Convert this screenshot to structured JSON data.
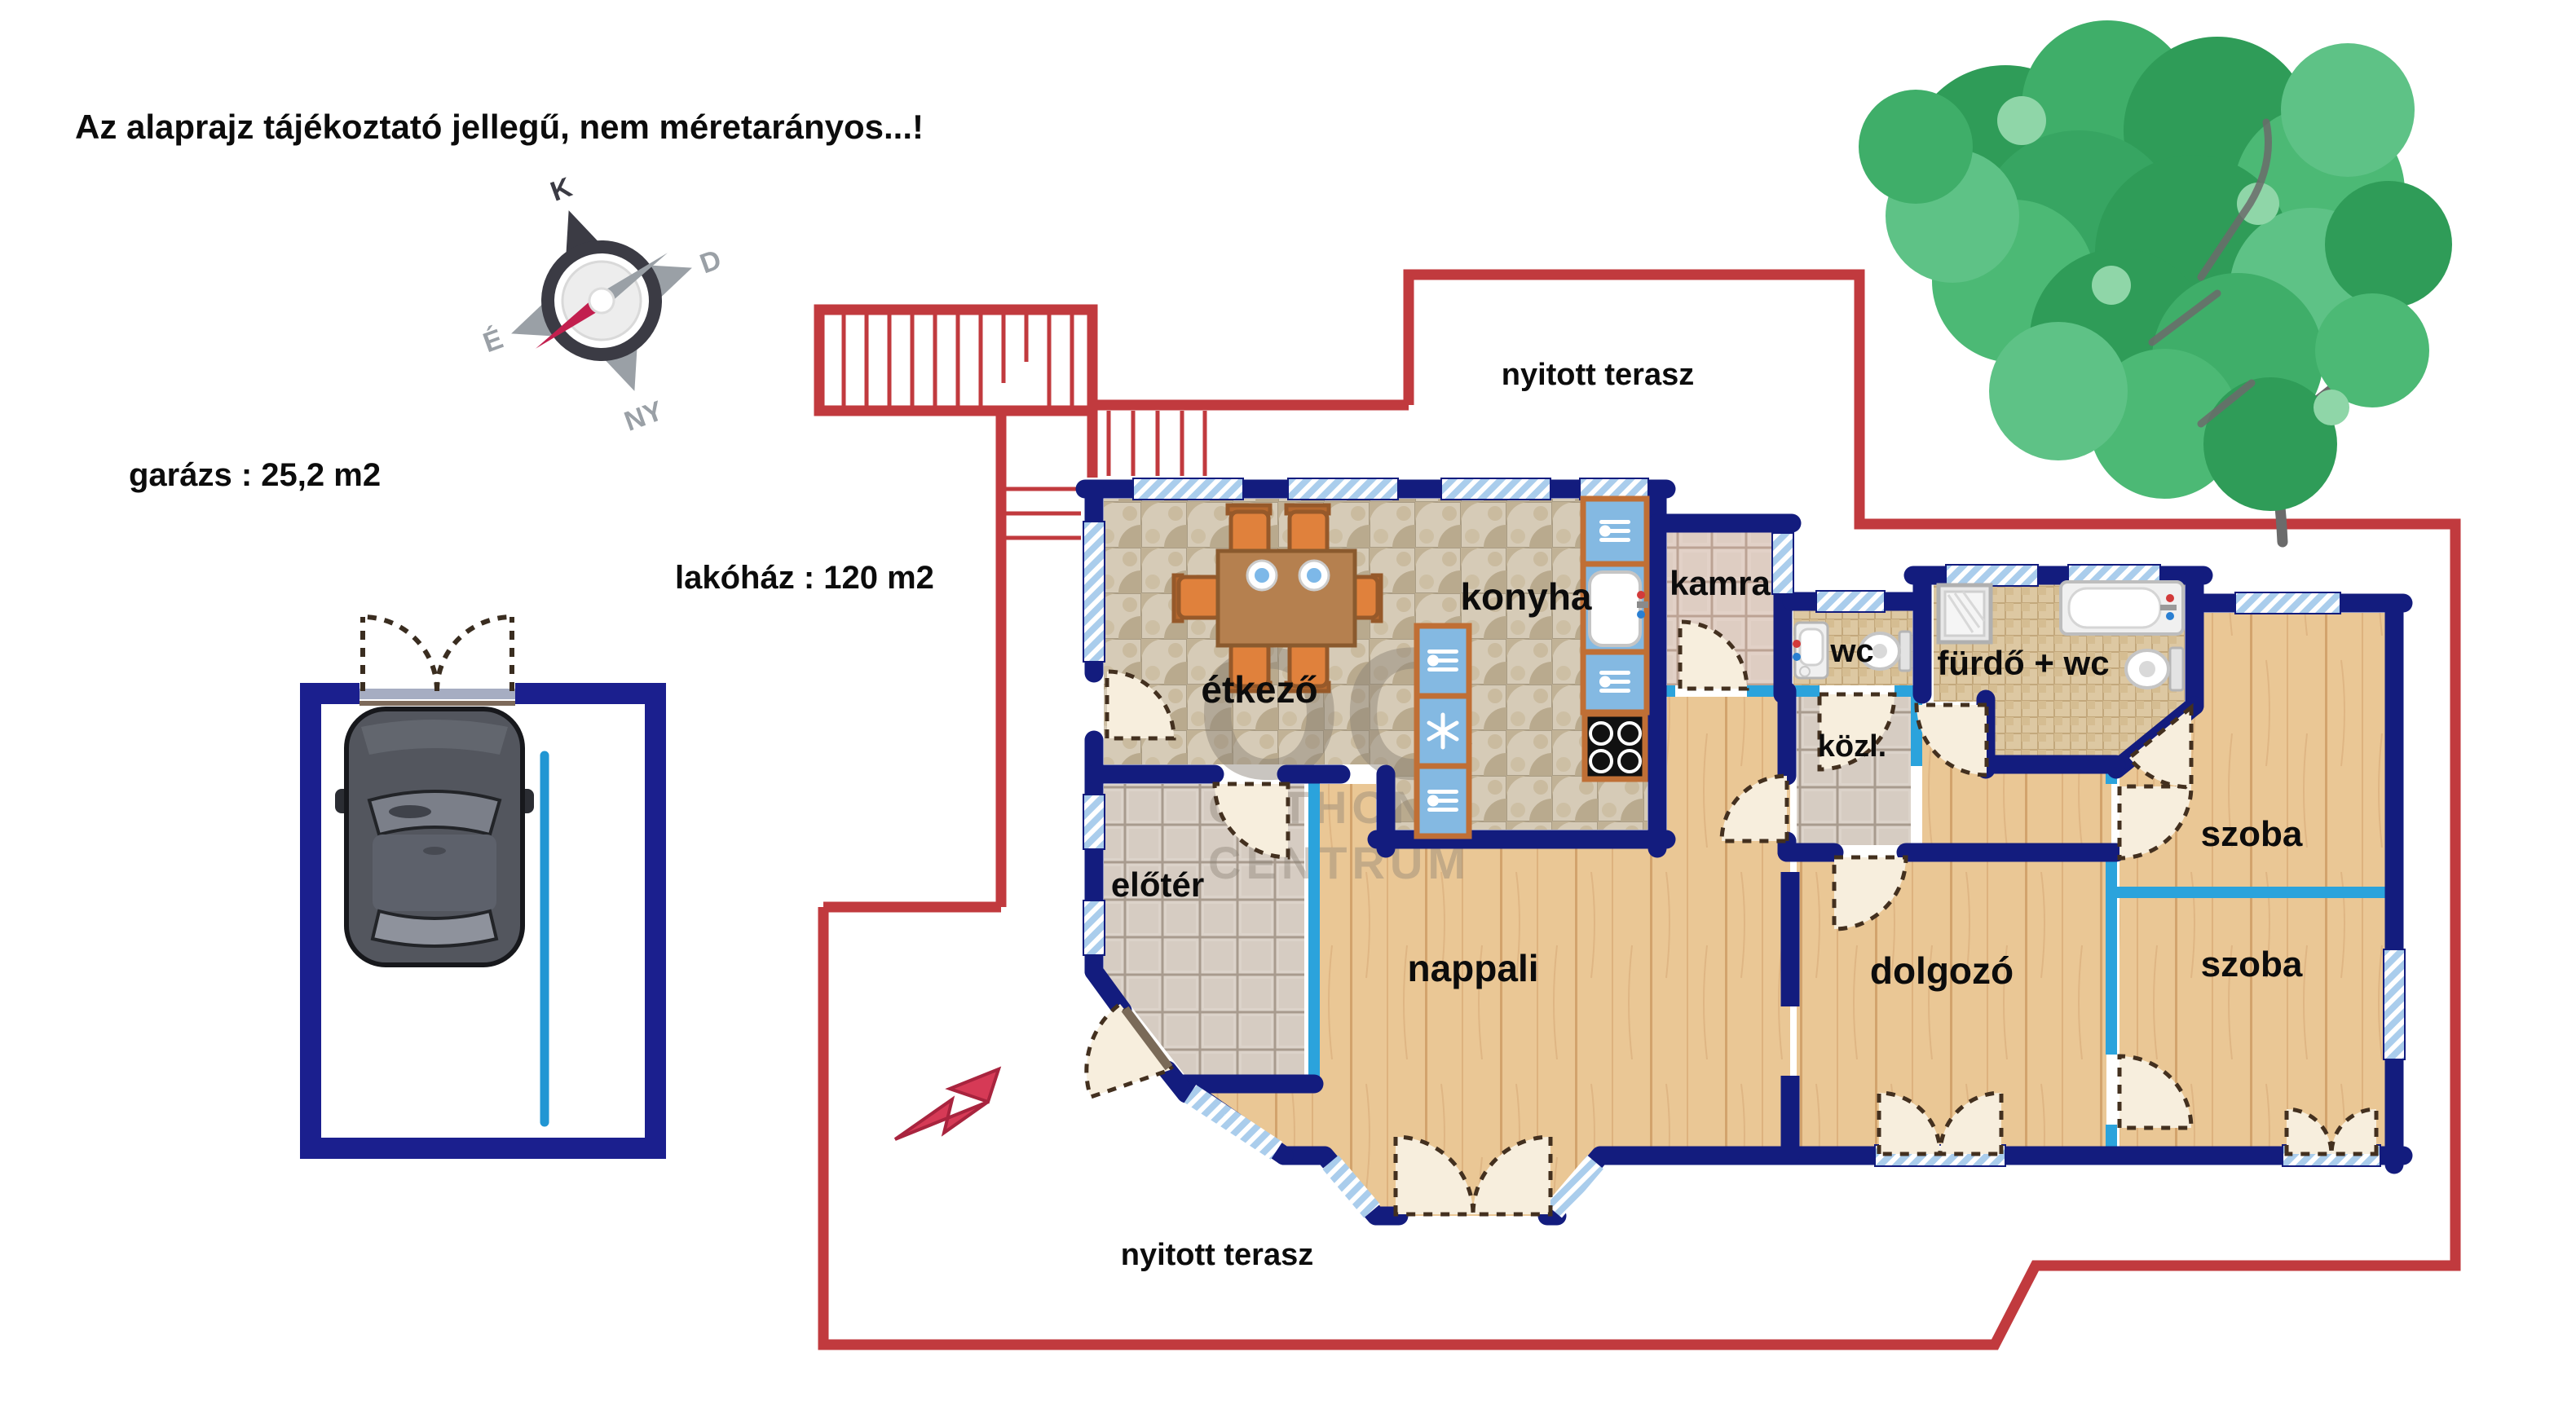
{
  "texts": {
    "disclaimer": "Az alaprajz tájékoztató jellegű, nem méretarányos...!",
    "garage_area": "garázs : 25,2 m2",
    "house_area": "lakóház : 120 m2",
    "terrace_top": "nyitott terasz",
    "terrace_bottom": "nyitott terasz"
  },
  "rooms": {
    "etkezo": "étkező",
    "konyha": "konyha",
    "kamra": "kamra",
    "wc": "wc",
    "furdo": "fürdő + wc",
    "kozl": "közl.",
    "eloter": "előtér",
    "nappali": "nappali",
    "dolgozo": "dolgozó",
    "szoba1": "szoba",
    "szoba2": "szoba"
  },
  "compass": {
    "top": "K",
    "right": "D",
    "bottom": "NY",
    "left": "É"
  },
  "watermark": {
    "monogram": "ŐC",
    "line1": "OTTHON",
    "line2": "CENTRUM"
  },
  "colors": {
    "wall_navy": "#131c7e",
    "wall_cyan": "#2ba3dc",
    "terrace_red": "#c13a3e",
    "wood_floor": "#eac795",
    "tile_beige": "#d6cbb7",
    "window_blue": "#aacdec",
    "furniture_orange": "#e0813c",
    "counter_blue": "#84b9e2",
    "garage_line_blue": "#2196d3",
    "tree_green": "#2f9c58",
    "arrow_pink": "#d63a56"
  }
}
